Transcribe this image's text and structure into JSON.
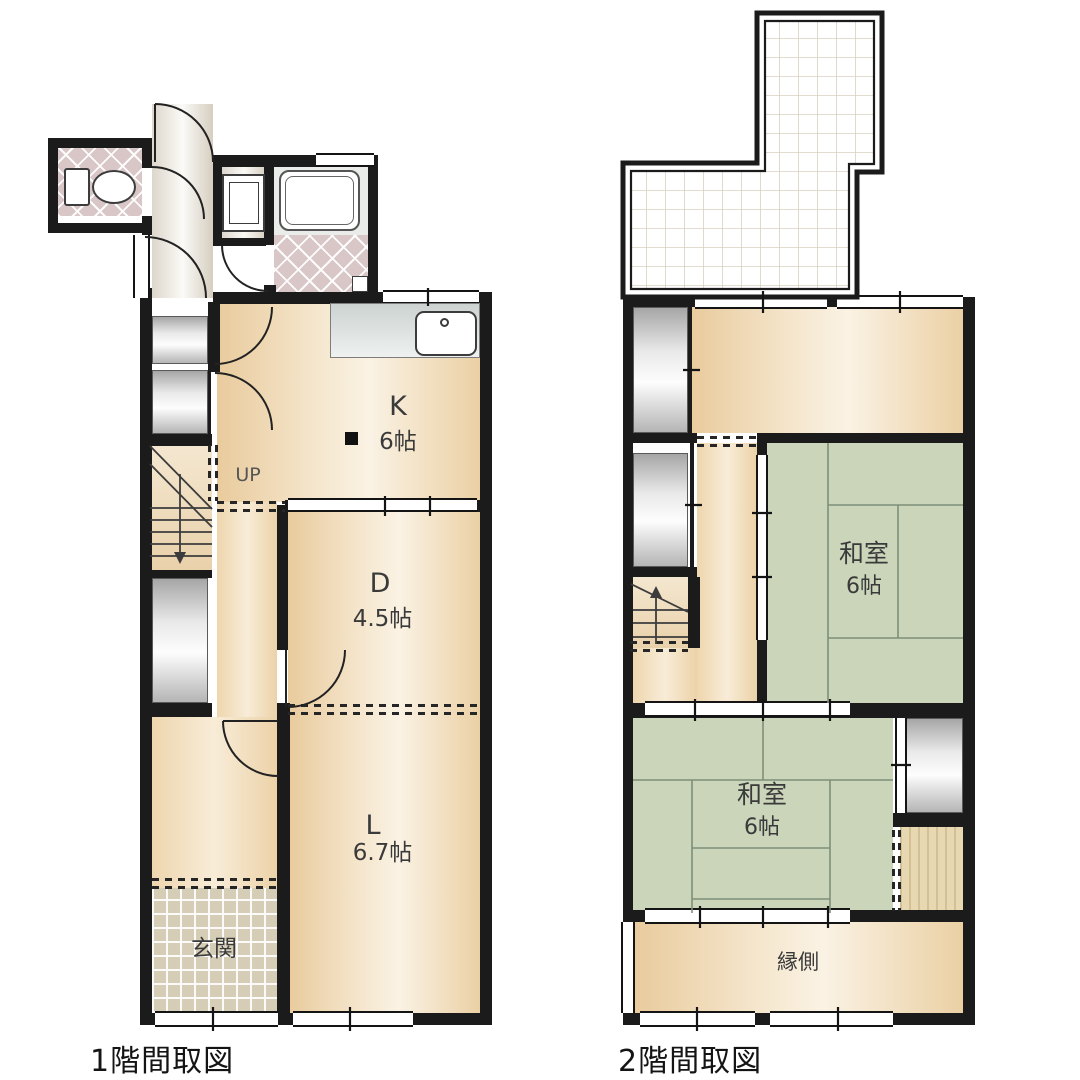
{
  "floor1": {
    "title": "1階間取図",
    "kitchen_label": "K",
    "kitchen_size": "6帖",
    "dining_label": "D",
    "dining_size": "4.5帖",
    "living_label": "L",
    "living_size": "6.7帖",
    "entrance_label": "玄関",
    "stairs_label": "UP"
  },
  "floor2": {
    "title": "2階間取図",
    "balcony_label": "バルコニー",
    "japanese_room1_label": "和室",
    "japanese_room1_size": "6帖",
    "japanese_room2_label": "和室",
    "japanese_room2_size": "6帖",
    "veranda_label": "縁側"
  },
  "colors": {
    "wall": "#1b1b1b",
    "tatami_green": "#cbd5ba",
    "room_beige": "#f3e4c9",
    "tile_pink": "#d9c6c6",
    "entrance_tile": "#d6cdb6"
  }
}
